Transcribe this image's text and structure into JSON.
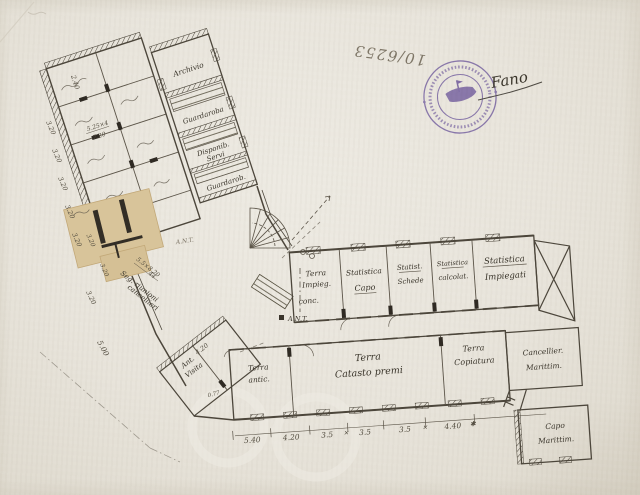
{
  "document": {
    "archive_number": "10/6253",
    "place_annotation": "Fano"
  },
  "stamp": {
    "color": "#7a64b4",
    "emblem": "ship-emblem"
  },
  "plan": {
    "nw_wing": {
      "archivio": "Archivio",
      "guardaroba": "Guardaroba",
      "disponibile_1": "Disponib.",
      "disponibile_2": "Servi",
      "guardarob": "Guardarob.",
      "area_num": "5.25×4",
      "area_den": "7.20"
    },
    "east_wing": {
      "terra_impieg_1": "Terra",
      "terra_impieg_2": "Impieg.",
      "terra_impieg_3": "conc.",
      "stat_capo_1": "Statistica",
      "stat_capo_2": "Capo",
      "stat_schede_1": "Statist.",
      "stat_schede_2": "Schede",
      "stat_calcolat_1": "Statistica",
      "stat_calcolat_2": "calcolat.",
      "stat_impiegati_1": "Statistica",
      "stat_impiegati_2": "Impiegati"
    },
    "south_wing": {
      "terra_antic_1": "Terra",
      "terra_antic_2": "antic.",
      "catasto_1": "Terra",
      "catasto_2": "Catasto premi",
      "copiatura_1": "Terra",
      "copiatura_2": "Copiatura",
      "cancellier_1": "Cancellier.",
      "cancellier_2": "Marittim.",
      "capo_marittimo_1": "Capo",
      "capo_marittimo_2": "Marittim."
    },
    "junction": {
      "ant_upper": "A.N.T.",
      "ant_lower": "A.N.T.",
      "visita_1": "Ant.",
      "visita_2": "Visita",
      "seg_1": "Seg. riunioni",
      "seg_2": "cancellieri",
      "area_num": "5.5×8.20",
      "area_den": "44",
      "door_width": "0.77"
    },
    "dims": {
      "left": [
        "3.20",
        "3.20",
        "3.20",
        "3.20",
        "3.20",
        "3.20"
      ],
      "patch": [
        "3.20",
        "3.20"
      ],
      "top": "2.40",
      "d500": "5.00",
      "visita": "4.20",
      "bottom": [
        "5.40",
        "4.20",
        "3.5",
        "3.5",
        "3.5",
        "4.40"
      ],
      "marks": [
        "✕",
        "✕",
        "✱"
      ]
    }
  }
}
